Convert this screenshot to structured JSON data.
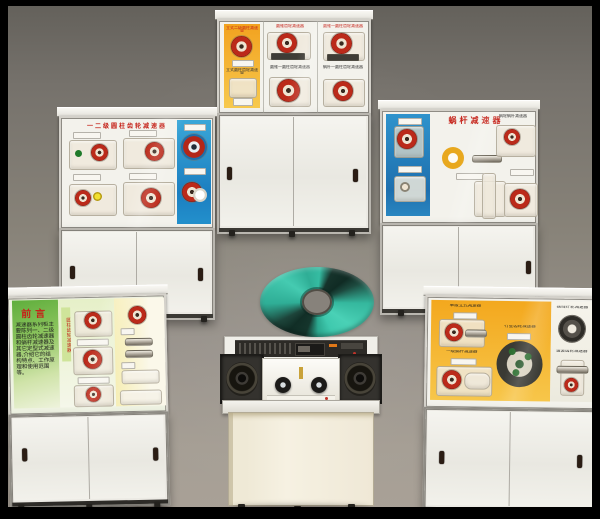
{
  "colors": {
    "background_wall": "#888379",
    "border_frame": "#000000",
    "cabinet_white": "#f2f1ec",
    "panel_orange": "#f3a81e",
    "panel_blue": "#2a8fc8",
    "panel_green": "#5fae3c",
    "panel_pale_yellow": "#f6eeb6",
    "accent_red": "#bb2a1a",
    "cd_teal": "#3fc9ae"
  },
  "cabinets": {
    "top_left": {
      "title": "一二级圆柱齿轮减速器"
    },
    "top_center": {
      "label_orange_top": "立式二级圆柱减速器",
      "label_orange_mid": "立式圆柱齿轮减速器",
      "label_mid_top": "圆锥齿轮减速器",
      "label_right_top": "圆锥一圆柱齿轮减速器",
      "label_mid_lower": "圆锥一圆柱齿轮减速器",
      "label_right_lower": "蜗杆一圆柱齿轮减速器"
    },
    "top_right": {
      "title": "蜗杆减速器",
      "label_top_right": "蜗轮蜗杆减速器"
    },
    "bottom_left": {
      "preface_title": "前言",
      "preface_body": "减速器系列柜主要陈列一、二级圆柱齿轮减速器和蜗杆减速器及其它定型式减速器,介绍它的结构特点、工作原理和使用范围等。",
      "side_strip": "圆柱齿轮减速器"
    },
    "bottom_right": {
      "label_a": "单级立式减速器",
      "label_b": "一级蜗杆减速器",
      "label_c": "行星齿轮减速器",
      "label_d": "摆线针轮减速器",
      "label_e": "谐波齿轮减速器"
    }
  }
}
